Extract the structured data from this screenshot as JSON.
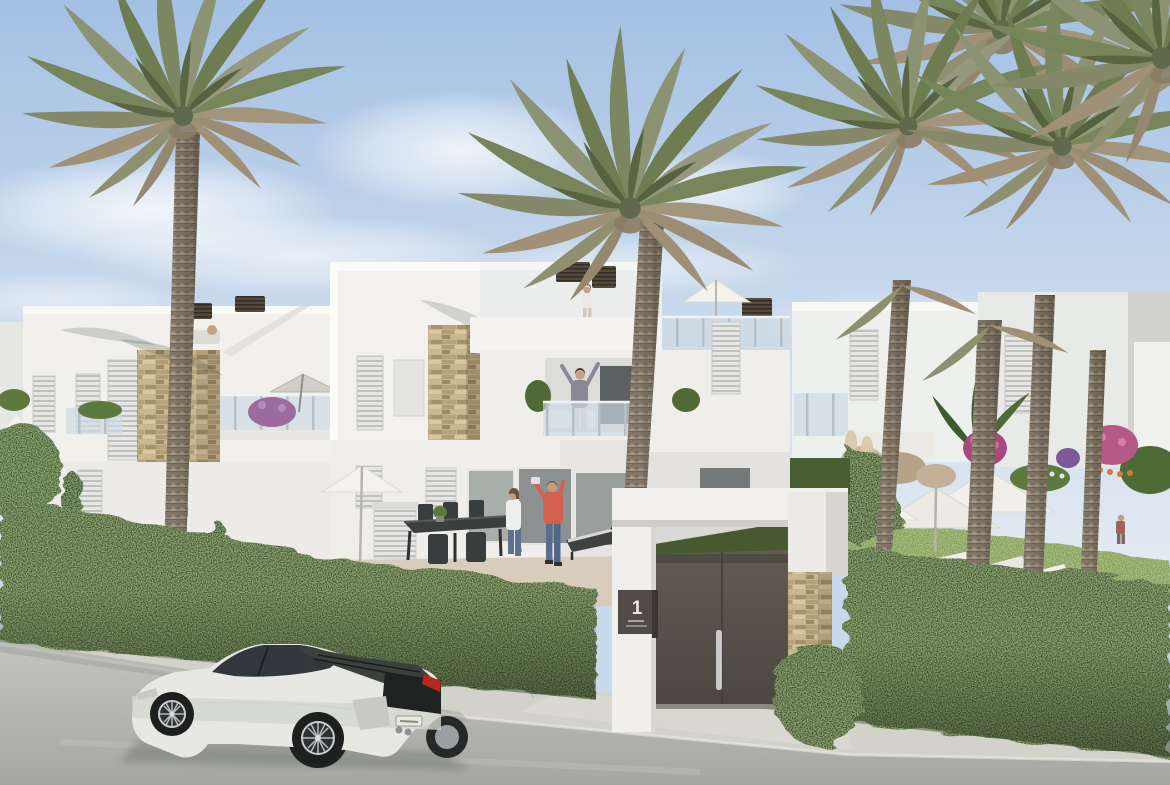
{
  "meta": {
    "title": "New-build Mediterranean townhouses - street view",
    "media_type": "photorealistic 3D architectural render"
  },
  "gate": {
    "sign_number": "1"
  },
  "scene": {
    "sky": "clear light-blue sky with soft white clouds near the horizon",
    "buildings": "white modern townhouses with roof terraces, glass balustrades, louvered shutters, stacked-stone accent columns and rattan chimney caps",
    "vegetation": "tall date palms, trimmed street hedge, garden lawn, purple and pink flowering shrubs, pampas grass, round tree and small conifer",
    "street": "light concrete road with kerb running diagonally across the foreground",
    "vehicle": "white sports car parked on the street facing left",
    "entrance": "white gate portal with dark grey double door, steel handle, number plaque and stacked-stone pillar",
    "people": [
      "woman pointing on the roof terrace",
      "man cheering on the first-floor balcony",
      "man taking a photo on the ground-floor terrace",
      "woman sitting at the outdoor dining table",
      "person walking in the right-hand garden",
      "child near the left hedge"
    ],
    "garden_furniture": "white parasols, sun loungers, dark outdoor dining set, grey cantilever parasol"
  },
  "palette": {
    "sky_top": "#a3c0e4",
    "sky_bottom": "#e2eaf2",
    "wall_white": "#f1f0ec",
    "wall_shade": "#d8d8d4",
    "stone": "#c6b28c",
    "hedge": "#42552f",
    "lawn": "#7f9b52",
    "road": "#b3b4af",
    "sidewalk": "#d2d2ca",
    "door": "#57514b",
    "plaque": "#514b45",
    "car_body": "#e7e8e4",
    "car_glass": "#31373b",
    "taillight": "#b02a20",
    "frond_green": "#77855a",
    "frond_dry": "#a09076",
    "trunk": "#94897a",
    "coral_shirt": "#d4604f",
    "jeans": "#5a6e8c"
  }
}
